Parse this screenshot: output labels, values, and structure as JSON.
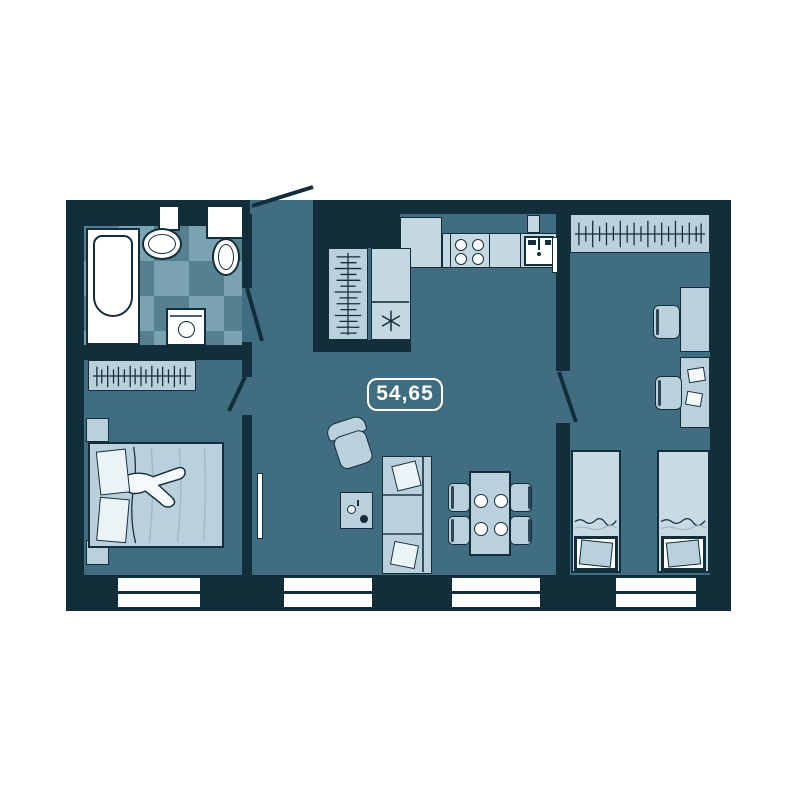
{
  "floorplan": {
    "area_label": "54,65"
  },
  "icons": {
    "kitchen_asterisk": "✳",
    "hanger_rail": "wardrobe-hangers",
    "door_swing": "door-leaf-arc"
  },
  "palette": {
    "page_background": "#ffffff",
    "wall": "#132e3b",
    "floor": "#406e80",
    "tile_light": "#7aa2b0",
    "tile_dark": "#55808f",
    "furniture": "#bad0dd",
    "furniture_bright": "#c8dae4",
    "counter": "#c4d8e2",
    "fixture_white": "#ffffff",
    "label_color": "#ffffff"
  }
}
